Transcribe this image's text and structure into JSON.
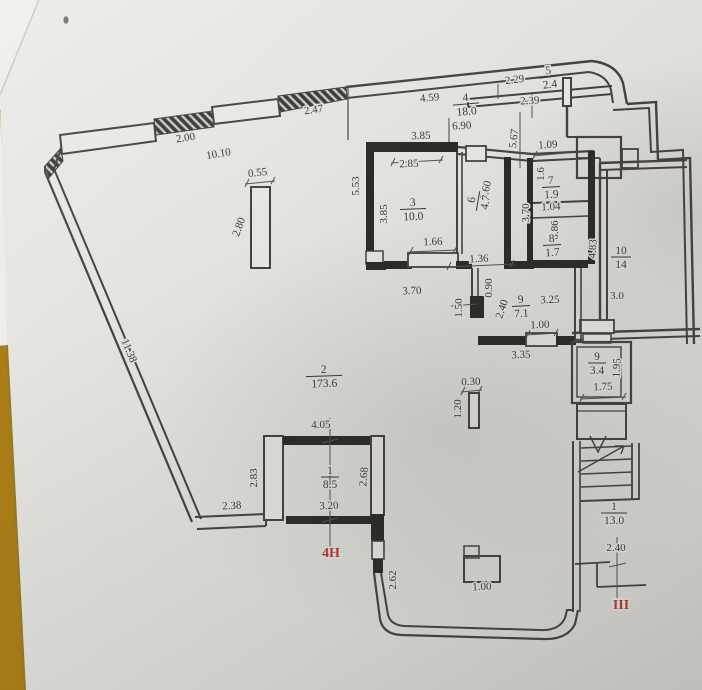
{
  "document": {
    "type": "floor-plan-photo",
    "colors": {
      "table_background": "#aa7d16",
      "paper": "#e2e1dd",
      "paper_light": "#efeeea",
      "ink_line": "#45433e",
      "wall_fill": "#2d2b28",
      "text": "#3b3934",
      "red_mark": "#b23a2e"
    }
  },
  "plan": {
    "room_labels": [
      {
        "num": "4",
        "area": "18.0",
        "x": 466,
        "y": 104,
        "rot": -5,
        "w": 13
      },
      {
        "num": "5",
        "area": "2.4",
        "x": 549,
        "y": 77,
        "rot": -7,
        "w": 10
      },
      {
        "num": "3",
        "area": "10.0",
        "x": 413,
        "y": 209,
        "rot": -2,
        "w": 13
      },
      {
        "num": "6",
        "area": "4.7",
        "x": 478,
        "y": 201,
        "rot": -80,
        "w": 10
      },
      {
        "num": "7",
        "area": "1.9",
        "x": 551,
        "y": 187,
        "rot": -3,
        "w": 9
      },
      {
        "num": "8",
        "area": "1.7",
        "x": 552,
        "y": 245,
        "rot": -3,
        "w": 9
      },
      {
        "num": "9",
        "area": "7.1",
        "x": 521,
        "y": 306,
        "rot": -3,
        "w": 9
      },
      {
        "num": "10",
        "area": "14",
        "x": 621,
        "y": 257,
        "rot": 0,
        "w": 10
      },
      {
        "num": "2",
        "area": "173.6",
        "x": 324,
        "y": 376,
        "rot": -2,
        "w": 18
      },
      {
        "num": "1",
        "area": "8.5",
        "x": 330,
        "y": 477,
        "rot": 0,
        "w": 9
      },
      {
        "num": "9",
        "area": "3.4",
        "x": 597,
        "y": 363,
        "rot": 0,
        "w": 9
      },
      {
        "num": "1",
        "area": "13.0",
        "x": 614,
        "y": 513,
        "rot": 0,
        "w": 13
      }
    ],
    "dim_labels": [
      {
        "text": "2.00",
        "x": 186,
        "y": 141,
        "rot": -9
      },
      {
        "text": "10.10",
        "x": 219,
        "y": 157,
        "rot": -9
      },
      {
        "text": "2.47",
        "x": 314,
        "y": 113,
        "rot": -8
      },
      {
        "text": "0.55",
        "x": 258,
        "y": 176,
        "rot": -7
      },
      {
        "text": "2.80",
        "x": 242,
        "y": 228,
        "rot": -70
      },
      {
        "text": "11.38",
        "x": 126,
        "y": 352,
        "rot": 67
      },
      {
        "text": "5.53",
        "x": 359,
        "y": 186,
        "rot": -90
      },
      {
        "text": "3.85",
        "x": 421,
        "y": 139,
        "rot": -2
      },
      {
        "text": "2.85",
        "x": 409,
        "y": 167,
        "rot": -2
      },
      {
        "text": "4.59",
        "x": 430,
        "y": 101,
        "rot": -6
      },
      {
        "text": "6.90",
        "x": 462,
        "y": 129,
        "rot": -4
      },
      {
        "text": "2.29",
        "x": 515,
        "y": 83,
        "rot": -7
      },
      {
        "text": "2.39",
        "x": 530,
        "y": 104,
        "rot": -3
      },
      {
        "text": "5.67",
        "x": 517,
        "y": 139,
        "rot": -83
      },
      {
        "text": "1.09",
        "x": 548,
        "y": 148,
        "rot": -3
      },
      {
        "text": "1.6",
        "x": 544,
        "y": 174,
        "rot": -90
      },
      {
        "text": "1.04",
        "x": 551,
        "y": 210,
        "rot": -2
      },
      {
        "text": "3.60",
        "x": 489,
        "y": 191,
        "rot": -77
      },
      {
        "text": "3.85",
        "x": 387,
        "y": 214,
        "rot": -90
      },
      {
        "text": "3.70",
        "x": 529,
        "y": 213,
        "rot": -90
      },
      {
        "text": "0.86",
        "x": 558,
        "y": 230,
        "rot": -90
      },
      {
        "text": "1.66",
        "x": 433,
        "y": 245,
        "rot": -2
      },
      {
        "text": "1.36",
        "x": 479,
        "y": 262,
        "rot": -2
      },
      {
        "text": "4.83",
        "x": 596,
        "y": 249,
        "rot": -87
      },
      {
        "text": "3.0",
        "x": 617,
        "y": 299,
        "rot": 0
      },
      {
        "text": "3.70",
        "x": 412,
        "y": 294,
        "rot": -2
      },
      {
        "text": "0.90",
        "x": 492,
        "y": 288,
        "rot": -90
      },
      {
        "text": "1.50",
        "x": 462,
        "y": 308,
        "rot": -90
      },
      {
        "text": "2.40",
        "x": 505,
        "y": 310,
        "rot": -72
      },
      {
        "text": "3.25",
        "x": 550,
        "y": 303,
        "rot": -2
      },
      {
        "text": "1.00",
        "x": 540,
        "y": 328,
        "rot": -2
      },
      {
        "text": "3.35",
        "x": 521,
        "y": 358,
        "rot": -2
      },
      {
        "text": "1.95",
        "x": 620,
        "y": 368,
        "rot": -87
      },
      {
        "text": "1.75",
        "x": 603,
        "y": 390,
        "rot": -2
      },
      {
        "text": "0.30",
        "x": 471,
        "y": 385,
        "rot": -2
      },
      {
        "text": "1.20",
        "x": 461,
        "y": 409,
        "rot": -90
      },
      {
        "text": "4.05",
        "x": 321,
        "y": 428,
        "rot": -2
      },
      {
        "text": "2.83",
        "x": 257,
        "y": 478,
        "rot": -90
      },
      {
        "text": "2.68",
        "x": 367,
        "y": 477,
        "rot": -85
      },
      {
        "text": "2.38",
        "x": 232,
        "y": 509,
        "rot": -3
      },
      {
        "text": "3.20",
        "x": 329,
        "y": 509,
        "rot": -2
      },
      {
        "text": "2.62",
        "x": 396,
        "y": 580,
        "rot": -90
      },
      {
        "text": "1.00",
        "x": 482,
        "y": 590,
        "rot": -2
      },
      {
        "text": "2.40",
        "x": 616,
        "y": 551,
        "rot": 0
      }
    ],
    "red_labels": [
      {
        "text": "4Н",
        "x": 331,
        "y": 557
      },
      {
        "text": "III",
        "x": 621,
        "y": 609
      }
    ]
  }
}
